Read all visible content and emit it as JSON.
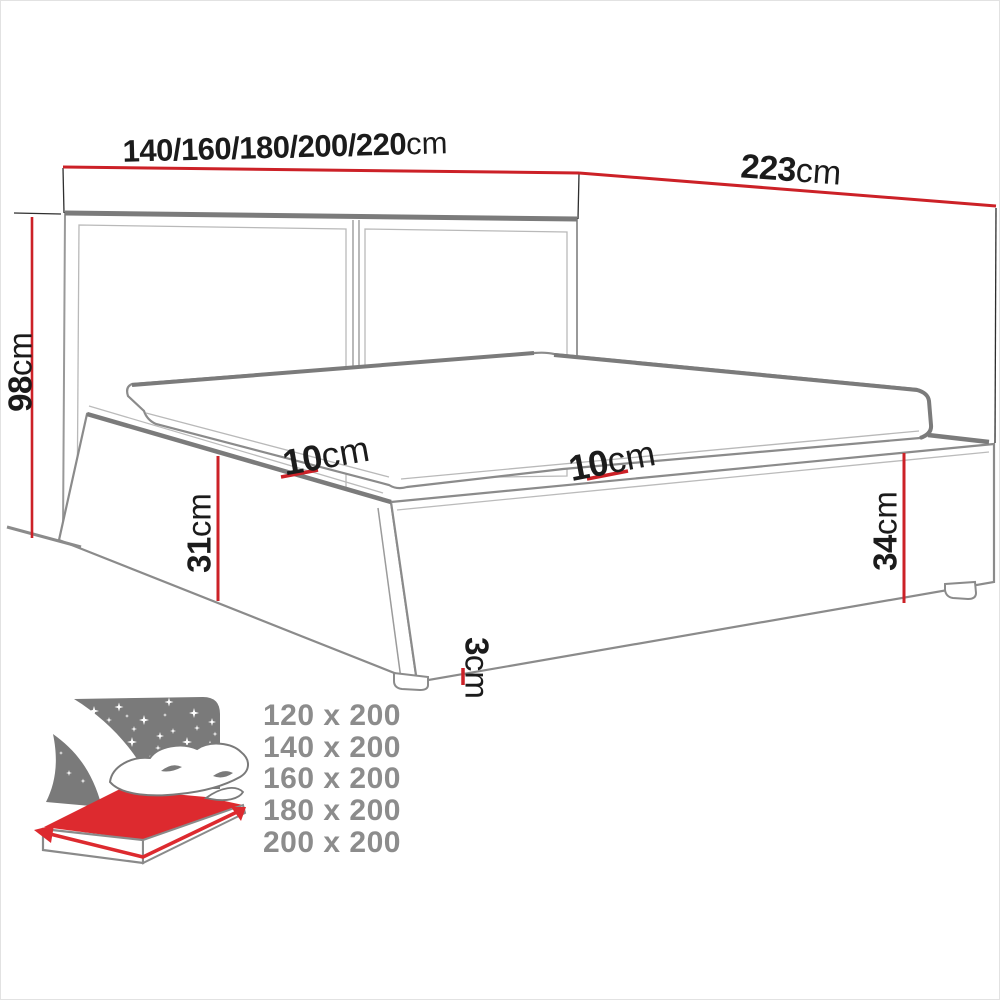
{
  "title": "bed-dimensions-diagram",
  "dimensions": {
    "width": {
      "value": "140/160/180/200/220",
      "unit": "cm"
    },
    "length": {
      "value": "223",
      "unit": "cm"
    },
    "height": {
      "value": "98",
      "unit": "cm"
    },
    "ledge_left": {
      "value": "10",
      "unit": "cm"
    },
    "ledge_right": {
      "value": "10",
      "unit": "cm"
    },
    "side_left": {
      "value": "31",
      "unit": "cm"
    },
    "side_right": {
      "value": "34",
      "unit": "cm"
    },
    "leg_height": {
      "value": "3",
      "unit": "cm"
    }
  },
  "sizes": {
    "items": [
      "120 x 200",
      "140 x 200",
      "160 x 200",
      "180 x 200",
      "200 x 200"
    ]
  },
  "icon": {
    "name": "bed-size-icon"
  },
  "colors": {
    "dimension_red": "#cc2127",
    "icon_red": "#dd2a2f",
    "sketch_gray": "#8b8b8b",
    "sketch_dark_gray": "#7b7b7b",
    "projection_black": "#2e2e2e",
    "text_dark": "#1b1b1b",
    "sizes_gray": "#8c8c8c",
    "icon_gray": "#7a7a7a"
  }
}
